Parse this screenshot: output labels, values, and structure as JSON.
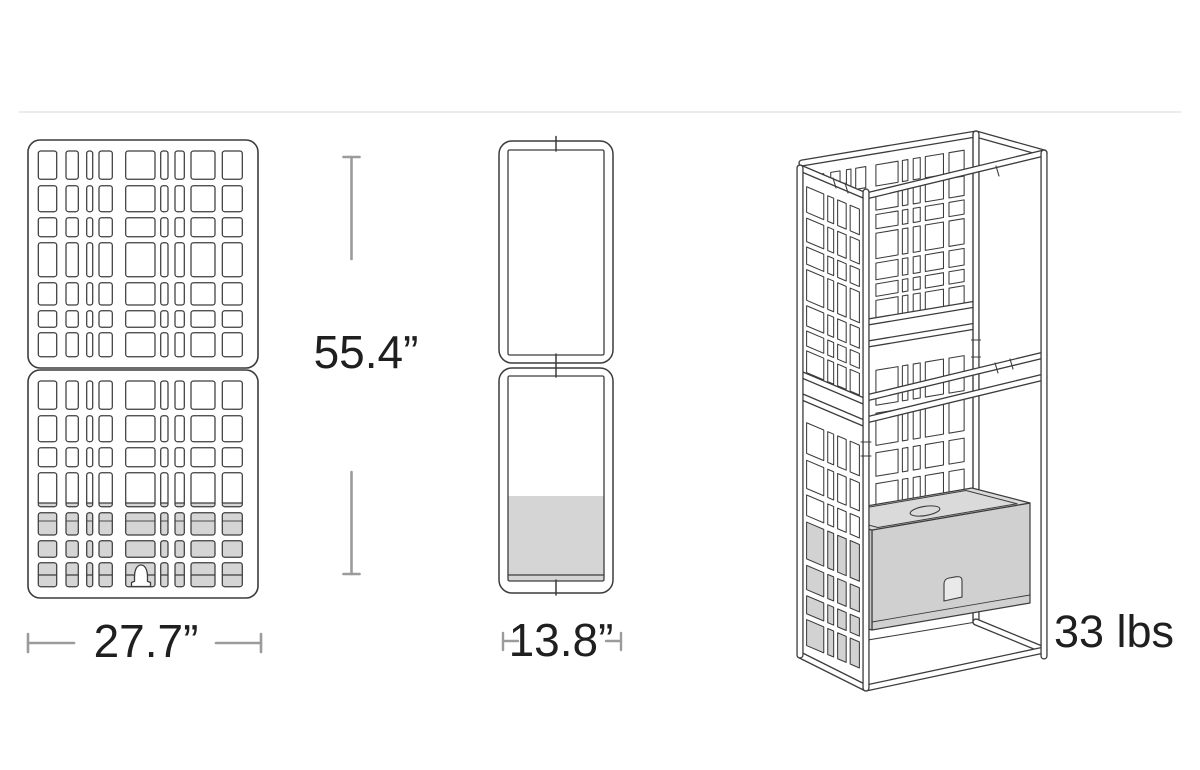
{
  "canvas": {
    "width": 1200,
    "height": 770,
    "background": "#ffffff"
  },
  "separator": {
    "color": "#ebebeb"
  },
  "palette": {
    "line": "#3c3c3c",
    "thin_line": "#4a4a4a",
    "dim_line": "#9b9b9b",
    "text": "#1f1f1f",
    "panel_fill": "#ffffff",
    "planter_gray": "#d5d5d5",
    "box_top_gray": "#dadada",
    "box_front_gray": "#d0d0d0",
    "box_side_gray": "#c6c6c6"
  },
  "labels": {
    "height": "55.4”",
    "width": "27.7”",
    "depth": "13.8”",
    "weight": "33 lbs"
  }
}
